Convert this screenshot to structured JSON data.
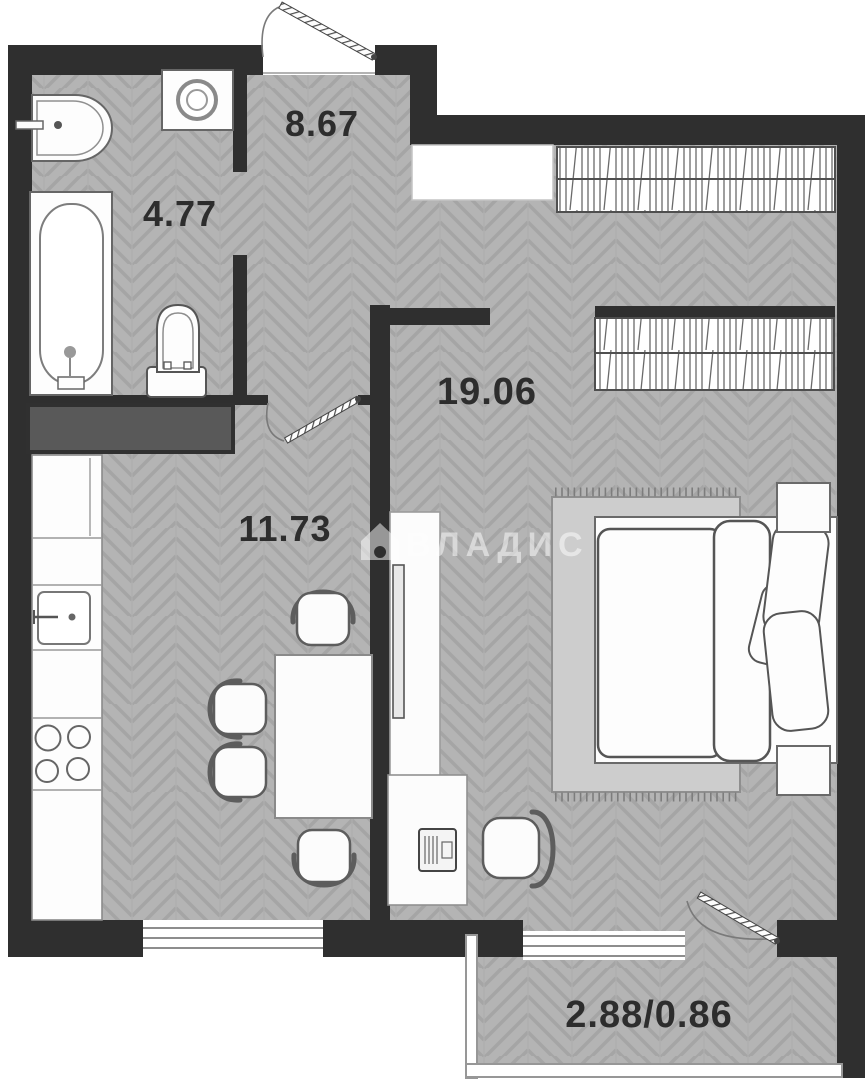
{
  "plan": {
    "title": "apartment-floor-plan",
    "rooms": {
      "hallway": {
        "area": "8.67"
      },
      "bathroom": {
        "area": "4.77"
      },
      "living": {
        "area": "19.06"
      },
      "kitchen": {
        "area": "11.73"
      },
      "balcony": {
        "area": "2.88/0.86"
      }
    },
    "watermark": {
      "text": "ВЛАДИС",
      "icon": "house-icon"
    },
    "colors": {
      "wall": "#2f2f2f",
      "floor_base": "#b4b4b4",
      "floor_line": "#a5a5a5",
      "closet_fill": "#595959",
      "furniture_stroke": "#5f5f5f",
      "window_line": "#8d8d8d",
      "label_text": "#2d2d2d"
    }
  }
}
